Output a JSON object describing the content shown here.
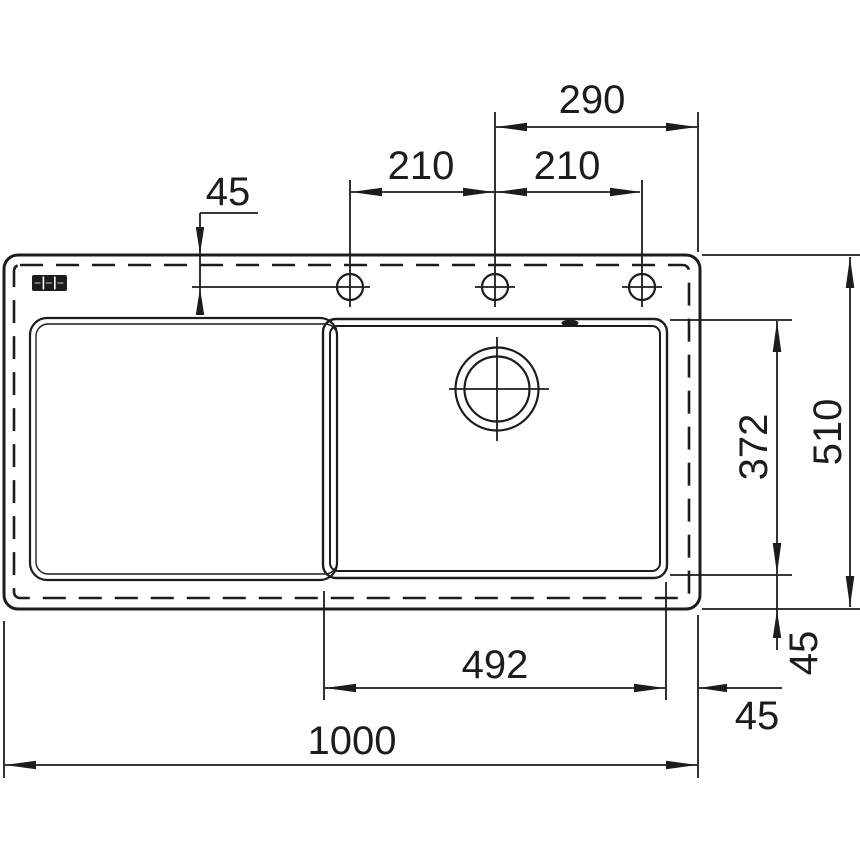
{
  "drawing": {
    "type": "kitchen-sink-installation-drawing",
    "view": "top-view",
    "background": "#ffffff",
    "line_color": "#1c1c1c",
    "logo": "franke-three-box-logo",
    "features": {
      "tap_holes": 3,
      "bowl": "right",
      "drainboard": "left",
      "drain": "circular-with-centerlines",
      "overflow_slot": "top-edge-of-bowl",
      "cutout_line_style": "dashed"
    },
    "dims": {
      "center_to_right_edge": "290",
      "hole_pitch_left": "210",
      "hole_pitch_right": "210",
      "edge_to_hole_axis": "45",
      "bowl_depth": "372",
      "overall_depth": "510",
      "bowl_width": "492",
      "overall_width": "1000",
      "bowl_offset_bottom": "45",
      "bowl_offset_right": "45"
    }
  }
}
